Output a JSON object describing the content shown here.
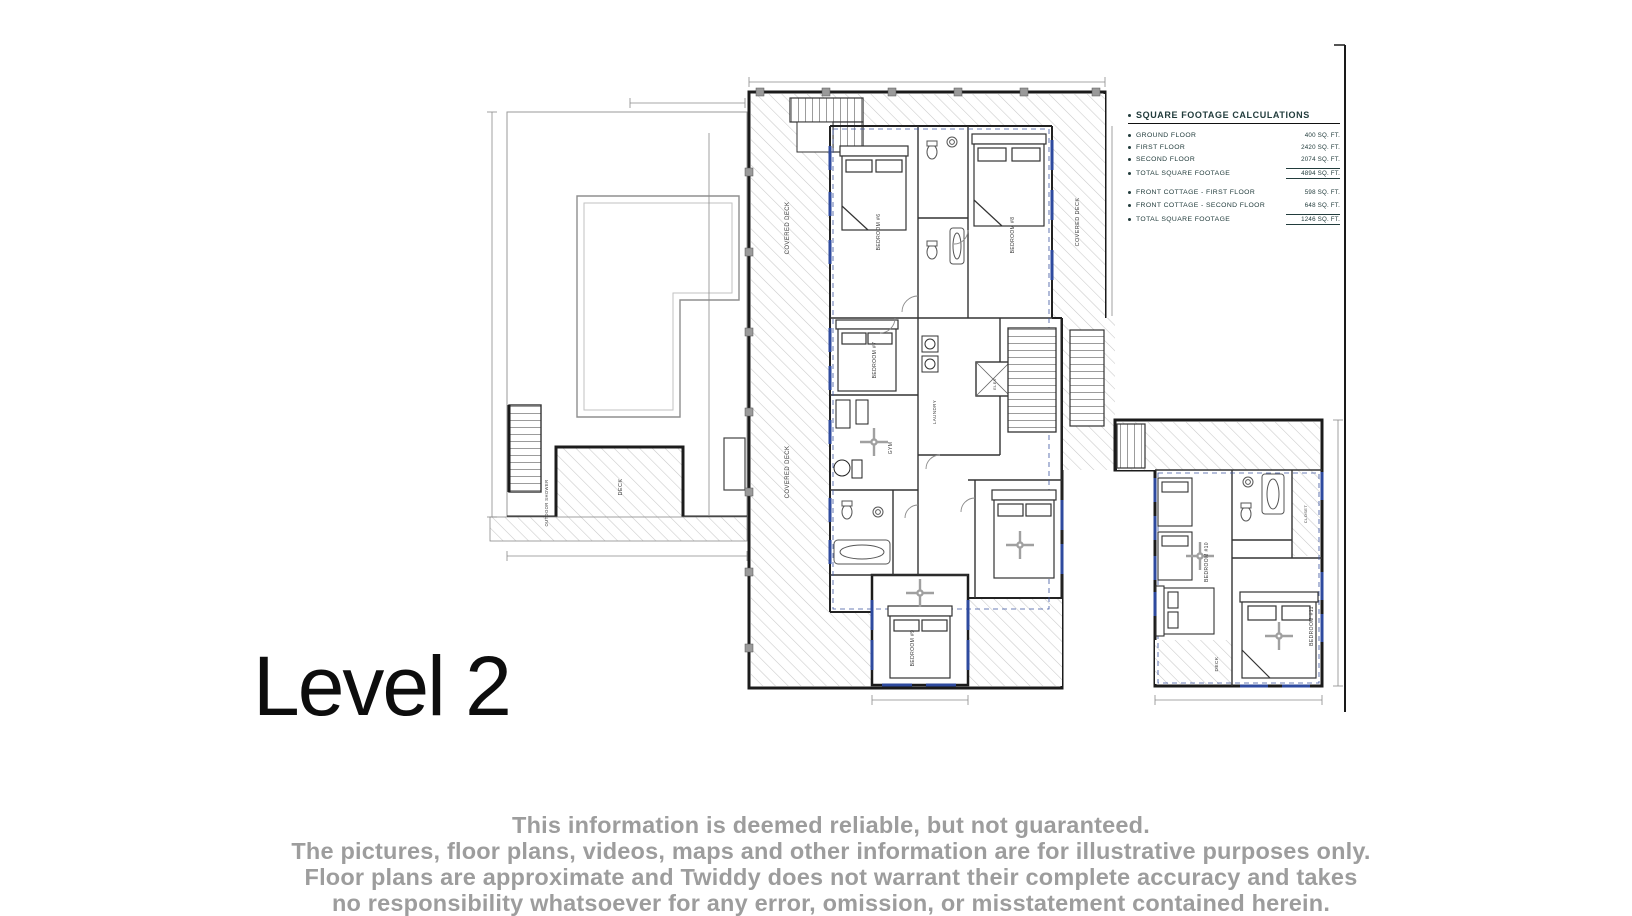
{
  "title": {
    "label": "Level 2"
  },
  "sqft_table": {
    "title": "SQUARE FOOTAGE CALCULATIONS",
    "rows": [
      {
        "label": "GROUND FLOOR",
        "value": "400 SQ. FT."
      },
      {
        "label": "FIRST FLOOR",
        "value": "2420 SQ. FT."
      },
      {
        "label": "SECOND FLOOR",
        "value": "2074 SQ. FT."
      },
      {
        "label": "TOTAL SQUARE FOOTAGE",
        "value": "4894 SQ. FT."
      },
      {
        "label": "FRONT COTTAGE - FIRST FLOOR",
        "value": "598 SQ. FT."
      },
      {
        "label": "FRONT COTTAGE - SECOND FLOOR",
        "value": "648 SQ. FT."
      },
      {
        "label": "TOTAL SQUARE FOOTAGE",
        "value": "1246 SQ. FT."
      }
    ]
  },
  "plan": {
    "labels": {
      "covered_deck": "COVERED DECK",
      "deck": "DECK",
      "outdoor_shower": "OUTDOOR SHOWER",
      "bedroom6": "BEDROOM #6",
      "bedroom7": "BEDROOM #7",
      "bedroom8": "BEDROOM #8",
      "bedroom9": "BEDROOM #9",
      "bedroom10": "BEDROOM #10",
      "bedroom11": "BEDROOM #11",
      "gym": "GYM",
      "laundry": "LAUNDRY",
      "elev": "ELEV",
      "closet": "CLOSET"
    }
  },
  "disclaimer": {
    "line1": "This information is deemed reliable, but not guaranteed.",
    "line2": "The pictures, floor plans, videos, maps and other information are for illustrative purposes only.",
    "line3": "Floor plans are approximate and Twiddy does not warrant their complete accuracy and takes",
    "line4": "no responsibility whatsoever for any error, omission, or misstatement contained herein."
  },
  "colors": {
    "wall": "#1b1b1b",
    "window_accent": "#2e4a9e",
    "hatch": "#c9c9c9",
    "dimension_line": "#8a8a8a",
    "disclaimer_text": "#9d9d9d",
    "table_text": "#223c3c"
  }
}
